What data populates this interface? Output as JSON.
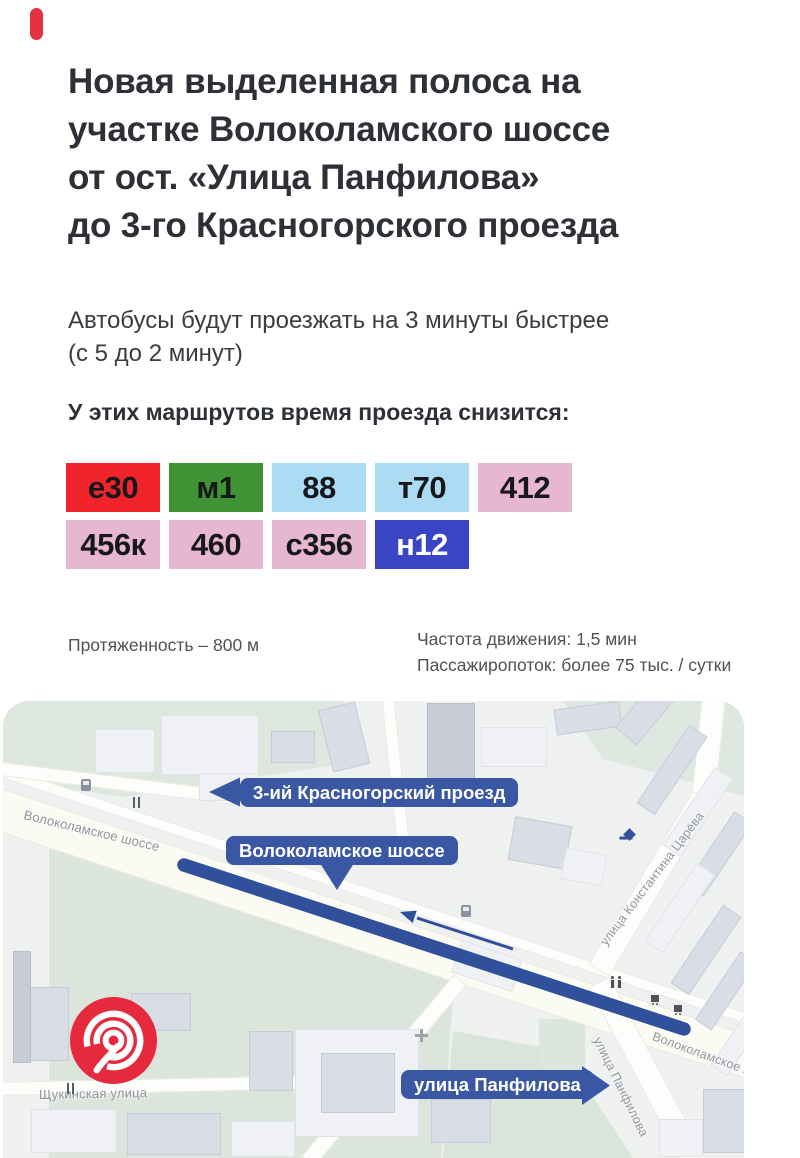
{
  "poster": {
    "title_lines": [
      "Новая выделенная полоса на",
      "участке Волоколамского шоссе",
      "от ост. «Улица Панфилова»",
      "до 3-го Красногорского проезда"
    ],
    "intro_lines": [
      "Автобусы будут проезжать на 3 минуты быстрее",
      "(с 5 до 2 минут)"
    ],
    "routes_heading": "У этих маршрутов время проезда снизится:",
    "stats": {
      "length": "Протяженность – 800 м",
      "frequency": "Частота движения: 1,5 мин",
      "passenger_flow": "Пассажиропоток: более 75 тыс. / сутки"
    }
  },
  "routes": {
    "badges": [
      {
        "label": "е30",
        "bg": "#f1242c",
        "fg": "#17181c"
      },
      {
        "label": "м1",
        "bg": "#3f9334",
        "fg": "#17181c"
      },
      {
        "label": "88",
        "bg": "#abdcf4",
        "fg": "#17181c"
      },
      {
        "label": "т70",
        "bg": "#abdcf4",
        "fg": "#17181c"
      },
      {
        "label": "412",
        "bg": "#e7b6d0",
        "fg": "#17181c"
      },
      {
        "label": "456к",
        "bg": "#e7b6d0",
        "fg": "#17181c"
      },
      {
        "label": "460",
        "bg": "#e7b6d0",
        "fg": "#17181c"
      },
      {
        "label": "с356",
        "bg": "#e7b6d0",
        "fg": "#17181c"
      },
      {
        "label": "н12",
        "bg": "#3a45c6",
        "fg": "#ffffff"
      }
    ]
  },
  "map": {
    "callouts": [
      {
        "label": "3-ий Красногорский проезд",
        "arrow": "left"
      },
      {
        "label": "Волоколамское шоссе",
        "arrow": "down"
      },
      {
        "label": "улица Панфилова",
        "arrow": "right"
      }
    ],
    "street_labels": [
      "Волоколамское шоссе",
      "улица Константина Царёва",
      "улица Панфилова",
      "Щукинская улица",
      "Волоколамское шоссе"
    ],
    "colors": {
      "callout_blue": "#3a57a3",
      "lane_blue": "#31509c",
      "logo_red": "#e6293c",
      "accent_red": "#e4323f"
    }
  }
}
